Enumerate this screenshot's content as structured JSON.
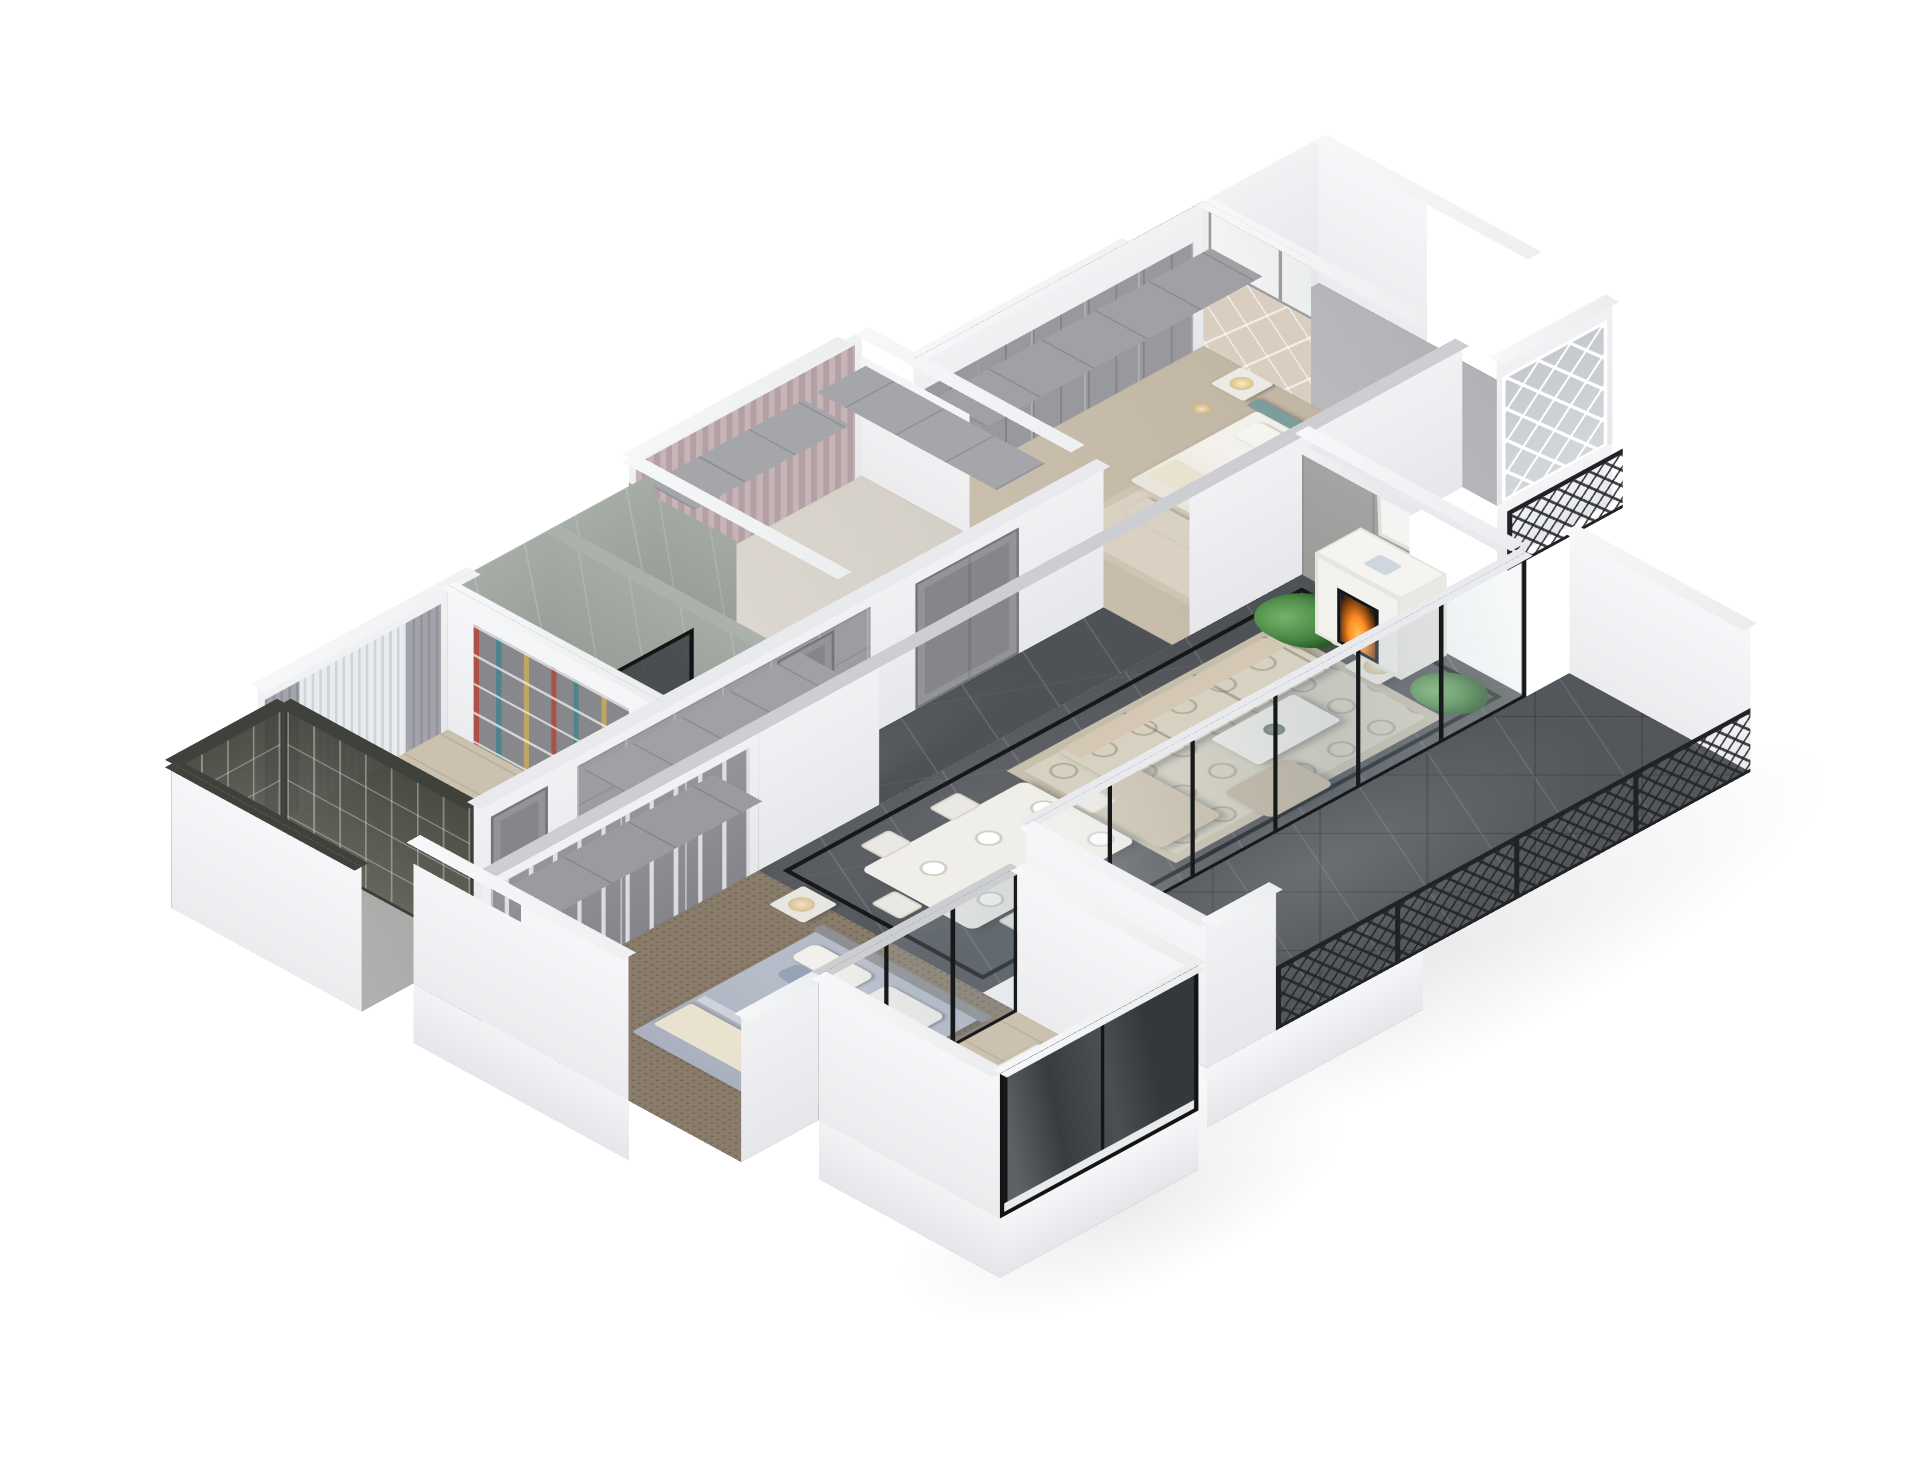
{
  "meta": {
    "type": "3d-apartment-cutaway-render",
    "view": "axonometric dollhouse, viewed from the south-west above",
    "background": "#ffffff",
    "visible_text": "none"
  },
  "colors": {
    "wallWhite": "#f4f5f7",
    "wallShade": "#e8e9ec",
    "wallTop": "#f7f8fa",
    "beamGrey": "#cdced2",
    "beamLight": "#e9eaee",
    "marble": "#4e5156",
    "marbleBath": "#9aa19b",
    "carpet": "#8a7c6b",
    "wood": "#ccc1ae",
    "frame": "#17181a",
    "rail": "#202226",
    "grille": "#4a4c44",
    "panelGrey": "#9b9b99",
    "doorGrey": "#85868a",
    "sofa": "#c7baa6",
    "rug": "#d7d1c1",
    "teal": "#7c9d9b",
    "fire": "#ff8a24",
    "plant": "#3f7c3c",
    "plantL": "#74b368",
    "duvet": "#b6bbc8",
    "cream": "#e9e2cf",
    "pinkCurtain": "#c6b4b7",
    "greyCurtain": "#a3a3ab",
    "beige": "#d9cec0",
    "white": "#ffffff"
  },
  "rooms": [
    {
      "id": "entry-balcony-nw",
      "floor": "grey screed",
      "features": [
        "dark bronze lattice glazing",
        "white parapet walls"
      ]
    },
    {
      "id": "study",
      "floor": "light wood",
      "features": [
        "window with grey curtains and sheer",
        "bookshelf wall with books",
        "small desk"
      ]
    },
    {
      "id": "bathroom",
      "floor": "grey-green marble",
      "features": [
        "marble clad walls",
        "black framed glass shower screen",
        "white fixtures"
      ]
    },
    {
      "id": "dressing-room",
      "floor": "pale screed with cream rug",
      "features": [
        "pink curtains",
        "grey glazed wardrobes",
        "overhead cabinets"
      ]
    },
    {
      "id": "master-bedroom",
      "floor": "beige carpet with rug",
      "features": [
        "teal upholstered headboard",
        "diamond padded feature wall",
        "wardrobe run",
        "nightstand with lamp",
        "floor lamp"
      ]
    },
    {
      "id": "master-balcony",
      "floor": "grey stone",
      "features": [
        "white fretwork window screen",
        "black lattice railing",
        "white parapet"
      ]
    },
    {
      "id": "hallway",
      "floor": "dark marble",
      "features": [
        "grey panelled wardrobe wall",
        "panelled doors",
        "double door"
      ]
    },
    {
      "id": "living-dining-room",
      "floor": "dark marble with black inlay border",
      "features": [
        "beige sofa set",
        "white coffee table",
        "quatrefoil cream rug",
        "dining table for six with white cross-back chairs",
        "white fireplace with burning fire",
        "monstera plants",
        "grey panelled feature wall",
        "white pelmet beams at cut height"
      ]
    },
    {
      "id": "glazed-terrace",
      "floor": "dark marble tiles laid diagonally",
      "features": [
        "black framed sliding glass wall",
        "black lattice railing",
        "white parapet ends",
        "white slab fascia"
      ]
    },
    {
      "id": "second-bedroom",
      "floor": "brown carpet",
      "features": [
        "bed with blue-grey duvet and cream throw",
        "glazed grey wardrobes",
        "nightstand with lamp",
        "black framed glass partition"
      ]
    },
    {
      "id": "south-balcony",
      "floor": "light wood with grey rug",
      "features": [
        "black framed windows",
        "white desk and chair",
        "white parapet walls"
      ]
    }
  ]
}
